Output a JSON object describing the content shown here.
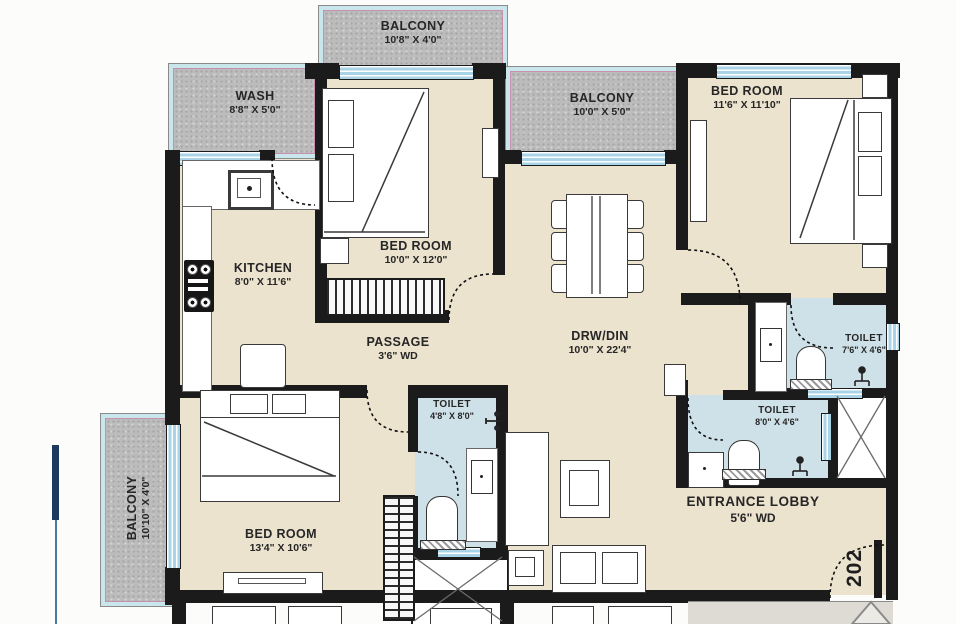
{
  "unit": {
    "number": "202"
  },
  "rooms": {
    "balcony_top": {
      "name": "BALCONY",
      "dim": "10'8\" X 4'0\""
    },
    "wash": {
      "name": "WASH",
      "dim": "8'8\" X 5'0\""
    },
    "balcony_mid": {
      "name": "BALCONY",
      "dim": "10'0\" X 5'0\""
    },
    "bedroom_top_right": {
      "name": "BED ROOM",
      "dim": "11'6\" X 11'10\""
    },
    "bedroom_top_mid": {
      "name": "BED ROOM",
      "dim": "10'0\" X 12'0\""
    },
    "kitchen": {
      "name": "KITCHEN",
      "dim": "8'0\" X 11'6\""
    },
    "passage": {
      "name": "PASSAGE",
      "dim": "3'6\" WD"
    },
    "drw_din": {
      "name": "DRW/DIN",
      "dim": "10'0\" X 22'4\""
    },
    "toilet_upper_right": {
      "name": "TOILET",
      "dim": "7'6\" X 4'6\""
    },
    "toilet_lower_right": {
      "name": "TOILET",
      "dim": "8'0\" X 4'6\""
    },
    "entrance_lobby": {
      "name": "ENTRANCE LOBBY",
      "dim": "5'6\" WD"
    },
    "bedroom_bottom": {
      "name": "BED ROOM",
      "dim": "13'4\" X 10'6\""
    },
    "toilet_bottom": {
      "name": "TOILET",
      "dim": "4'8\" X 8'0\""
    },
    "balcony_left": {
      "name": "BALCONY",
      "dim": "10'10\" X 4'0\""
    }
  },
  "colors": {
    "floor": "#ece3cf",
    "toilet": "#cfe1e8",
    "balcony": "#bcbcbc",
    "wall": "#1b1b1b",
    "window": "#a9d3e6",
    "border_cyan": "#c9e6ec",
    "border_pink": "#c791ad",
    "navy": "#1d3a5e"
  }
}
